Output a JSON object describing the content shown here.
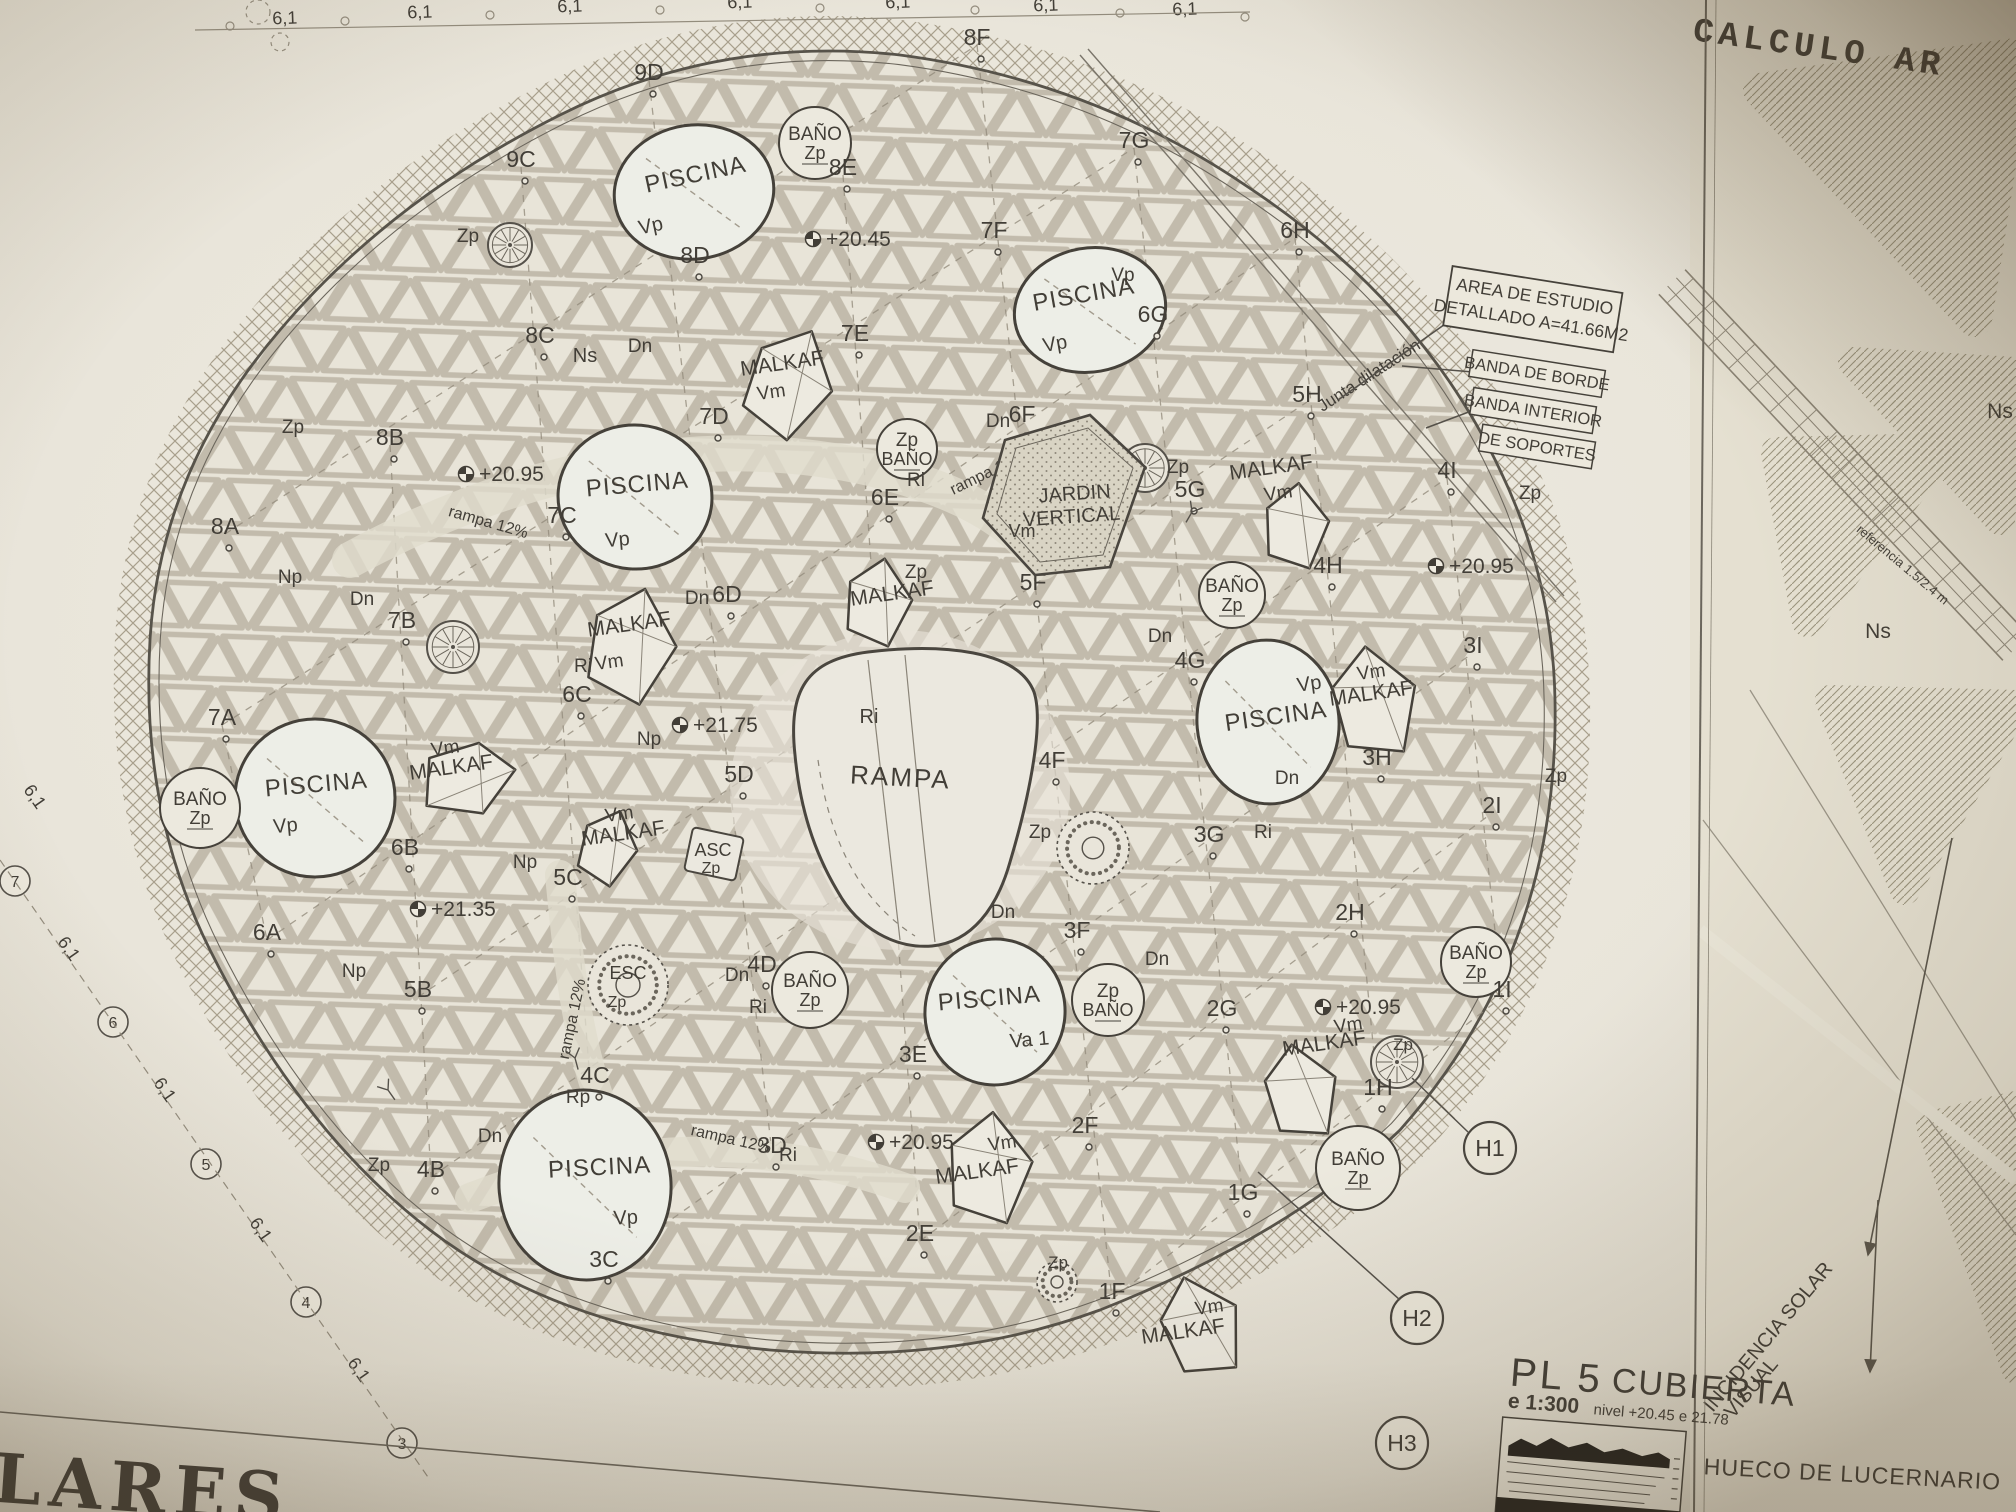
{
  "colors": {
    "paper": "#e9e5da",
    "ink": "#423e37",
    "ink_light": "#7b766a",
    "lattice": "#c0b9aa",
    "pool_fill": "#edeee7",
    "hatch": "#a89f8c"
  },
  "titles": {
    "corner": "CALCULO AR",
    "bottom_left": "LARES"
  },
  "title_block": {
    "code": "PL 5",
    "name": "CUBIERTA",
    "scale": "e 1:300",
    "levels": "nivel +20.45 e 21.78"
  },
  "callouts": {
    "area1": "AREA DE ESTUDIO",
    "area2": "DETALLADO A=41.66M2",
    "banda1": "BANDA DE BORDE",
    "banda2": "BANDA INTERIOR",
    "banda3": "DE SOPORTES"
  },
  "panel": {
    "hueco": "HUECO DE LUCERNARIO",
    "inc1": "INCIDENCIA SOLAR",
    "inc2": "VISUAL"
  },
  "labels": {
    "piscina": "PISCINA",
    "malkaf": "MALKAF",
    "vm": "Vm",
    "rampa": "RAMPA",
    "rampa_ri": "Ri",
    "jardin1": "JARDIN",
    "jardin2": "VERTICAL",
    "jardin_tag": "Vm",
    "asc1": "ASC",
    "asc2": "Zp",
    "esc1": "ESC",
    "esc2": "Zp"
  },
  "grid_points": [
    [
      "9C",
      521,
      167
    ],
    [
      "9D",
      649,
      80
    ],
    [
      "8A",
      225,
      534
    ],
    [
      "8B",
      390,
      445
    ],
    [
      "8C",
      540,
      343
    ],
    [
      "8D",
      695,
      263
    ],
    [
      "8E",
      843,
      175
    ],
    [
      "8F",
      977,
      45
    ],
    [
      "7A",
      222,
      725
    ],
    [
      "7B",
      402,
      628
    ],
    [
      "7C",
      562,
      523
    ],
    [
      "7D",
      714,
      424
    ],
    [
      "7E",
      855,
      341
    ],
    [
      "7F",
      994,
      238
    ],
    [
      "7G",
      1134,
      148
    ],
    [
      "6A",
      267,
      940
    ],
    [
      "6B",
      405,
      855
    ],
    [
      "6C",
      577,
      702
    ],
    [
      "6D",
      727,
      602
    ],
    [
      "6E",
      885,
      505
    ],
    [
      "6F",
      1022,
      422
    ],
    [
      "6G",
      1153,
      322
    ],
    [
      "6H",
      1295,
      238
    ],
    [
      "5B",
      418,
      997
    ],
    [
      "5C",
      568,
      885
    ],
    [
      "5D",
      739,
      782
    ],
    [
      "5F",
      1033,
      590
    ],
    [
      "5G",
      1190,
      497
    ],
    [
      "5H",
      1307,
      402
    ],
    [
      "4B",
      431,
      1177
    ],
    [
      "4C",
      595,
      1083
    ],
    [
      "4D",
      762,
      972
    ],
    [
      "4F",
      1052,
      768
    ],
    [
      "4G",
      1190,
      668
    ],
    [
      "4H",
      1328,
      573
    ],
    [
      "4I",
      1447,
      478
    ],
    [
      "3C",
      604,
      1267
    ],
    [
      "3D",
      772,
      1153
    ],
    [
      "3E",
      913,
      1062
    ],
    [
      "3F",
      1077,
      938
    ],
    [
      "3G",
      1209,
      842
    ],
    [
      "3H",
      1377,
      765
    ],
    [
      "3I",
      1473,
      653
    ],
    [
      "2E",
      920,
      1241
    ],
    [
      "2F",
      1085,
      1133
    ],
    [
      "2G",
      1222,
      1016
    ],
    [
      "2H",
      1350,
      920
    ],
    [
      "2I",
      1492,
      813
    ],
    [
      "1F",
      1112,
      1299
    ],
    [
      "1G",
      1243,
      1200
    ],
    [
      "1H",
      1378,
      1095
    ],
    [
      "1I",
      1502,
      997
    ]
  ],
  "levels": [
    [
      "+20.45",
      827,
      245
    ],
    [
      "+20.95",
      480,
      480
    ],
    [
      "+21.75",
      694,
      731
    ],
    [
      "+21.35",
      432,
      915
    ],
    [
      "+20.95",
      1450,
      572
    ],
    [
      "+20.95",
      890,
      1148
    ],
    [
      "+20.95",
      1337,
      1013
    ]
  ],
  "pools": [
    {
      "x": 694,
      "y": 192,
      "rx": 80,
      "ry": 67,
      "rot": -8,
      "lx": 697,
      "ly": 182,
      "lr": -12,
      "tag": "Vp",
      "tx": 652,
      "ty": 232
    },
    {
      "x": 1090,
      "y": 310,
      "rx": 76,
      "ry": 62,
      "rot": -10,
      "lx": 1085,
      "ly": 302,
      "lr": -10,
      "tag": "Vp",
      "tx": 1056,
      "ty": 350
    },
    {
      "x": 635,
      "y": 497,
      "rx": 77,
      "ry": 72,
      "rot": 5,
      "lx": 638,
      "ly": 492,
      "lr": -5,
      "tag": "Vp",
      "tx": 618,
      "ty": 546
    },
    {
      "x": 315,
      "y": 798,
      "rx": 80,
      "ry": 79,
      "rot": 0,
      "lx": 317,
      "ly": 792,
      "lr": -5,
      "tag": "Vp",
      "tx": 286,
      "ty": 832
    },
    {
      "x": 1268,
      "y": 722,
      "rx": 71,
      "ry": 82,
      "rot": -5,
      "lx": 1277,
      "ly": 724,
      "lr": -8,
      "tag": "Vp",
      "tx": 1310,
      "ty": 690
    },
    {
      "x": 995,
      "y": 1012,
      "rx": 70,
      "ry": 73,
      "rot": 8,
      "lx": 990,
      "ly": 1006,
      "lr": -5,
      "tag": "Va 1",
      "tx": 1030,
      "ty": 1046
    },
    {
      "x": 585,
      "y": 1185,
      "rx": 86,
      "ry": 95,
      "rot": -5,
      "lx": 600,
      "ly": 1175,
      "lr": -3,
      "tag": "Vp",
      "tx": 626,
      "ty": 1224
    }
  ],
  "malkafs": [
    {
      "x": 788,
      "y": 382,
      "s": 56,
      "rot": 25,
      "lx": 783,
      "ly": 370,
      "vx": 772,
      "vy": 398
    },
    {
      "x": 630,
      "y": 645,
      "s": 58,
      "rot": 15,
      "lx": 630,
      "ly": 631,
      "vx": 610,
      "vy": 668
    },
    {
      "x": 468,
      "y": 778,
      "s": 48,
      "rot": 80,
      "lx": 452,
      "ly": 774,
      "vx": 446,
      "vy": 754
    },
    {
      "x": 607,
      "y": 847,
      "s": 38,
      "rot": 20,
      "lx": 624,
      "ly": 840,
      "vx": 620,
      "vy": 820
    },
    {
      "x": 877,
      "y": 602,
      "s": 44,
      "rot": 10,
      "lx": 893,
      "ly": 600,
      "vx": null,
      "vy": null
    },
    {
      "x": 1373,
      "y": 702,
      "s": 56,
      "rot": -8,
      "lx": 1372,
      "ly": 700,
      "vx": 1372,
      "vy": 678
    },
    {
      "x": 1295,
      "y": 526,
      "s": 43,
      "rot": 5,
      "lx": 1272,
      "ly": 474,
      "vx": 1279,
      "vy": 499
    },
    {
      "x": 1300,
      "y": 1092,
      "s": 48,
      "rot": -10,
      "lx": 1325,
      "ly": 1050,
      "vx": 1349,
      "vy": 1031
    },
    {
      "x": 988,
      "y": 1168,
      "s": 56,
      "rot": 5,
      "lx": 978,
      "ly": 1178,
      "vx": 1003,
      "vy": 1149
    },
    {
      "x": 1200,
      "y": 1327,
      "s": 52,
      "rot": -18,
      "lx": 1184,
      "ly": 1338,
      "vx": 1210,
      "vy": 1313
    }
  ],
  "banos": [
    {
      "x": 815,
      "y": 143,
      "r": 36,
      "l1": "BAÑO",
      "l2": "Zp"
    },
    {
      "x": 200,
      "y": 808,
      "r": 40,
      "l1": "BAÑO",
      "l2": "Zp"
    },
    {
      "x": 907,
      "y": 449,
      "r": 30,
      "l1": "Zp",
      "l2": "BAÑO"
    },
    {
      "x": 1232,
      "y": 595,
      "r": 33,
      "l1": "BAÑO",
      "l2": "Zp"
    },
    {
      "x": 810,
      "y": 990,
      "r": 38,
      "l1": "BAÑO",
      "l2": "Zp"
    },
    {
      "x": 1108,
      "y": 1000,
      "r": 36,
      "l1": "Zp",
      "l2": "BAÑO"
    },
    {
      "x": 1476,
      "y": 962,
      "r": 35,
      "l1": "BAÑO",
      "l2": "Zp"
    },
    {
      "x": 1358,
      "y": 1168,
      "r": 42,
      "l1": "BAÑO",
      "l2": "Zp"
    }
  ],
  "rosettes": [
    {
      "x": 510,
      "y": 245,
      "r": 22,
      "style": "wheel"
    },
    {
      "x": 453,
      "y": 647,
      "r": 26,
      "style": "wheel"
    },
    {
      "x": 1145,
      "y": 468,
      "r": 24,
      "style": "wheel"
    },
    {
      "x": 1397,
      "y": 1062,
      "r": 26,
      "style": "wheel"
    },
    {
      "x": 1093,
      "y": 848,
      "r": 36,
      "style": "dotted"
    },
    {
      "x": 1057,
      "y": 1282,
      "r": 20,
      "style": "dotted"
    },
    {
      "x": 628,
      "y": 985,
      "r": 40,
      "style": "dotted"
    }
  ],
  "notes": [
    [
      "Zp",
      293,
      433,
      0,
      19
    ],
    [
      "Zp",
      468,
      242,
      0,
      19
    ],
    [
      "Zp",
      825,
      793,
      0,
      19
    ],
    [
      "Zp",
      968,
      849,
      0,
      19
    ],
    [
      "Zp",
      1040,
      838,
      0,
      19
    ],
    [
      "Zp",
      1178,
      473,
      0,
      19
    ],
    [
      "Zp",
      1530,
      499,
      0,
      19
    ],
    [
      "Zp",
      1556,
      782,
      0,
      19
    ],
    [
      "Zp",
      379,
      1171,
      0,
      19
    ],
    [
      "Zp",
      1403,
      1050,
      0,
      17
    ],
    [
      "Zp",
      1058,
      1268,
      0,
      17
    ],
    [
      "Zp",
      916,
      578,
      0,
      19
    ],
    [
      "Dn",
      998,
      427,
      0,
      19
    ],
    [
      "Dn",
      697,
      604,
      0,
      19
    ],
    [
      "Dn",
      362,
      605,
      0,
      19
    ],
    [
      "Dn",
      640,
      352,
      0,
      19
    ],
    [
      "Dn",
      1287,
      784,
      0,
      19
    ],
    [
      "Dn",
      1157,
      965,
      0,
      19
    ],
    [
      "Dn",
      1003,
      918,
      0,
      19
    ],
    [
      "Dn",
      737,
      981,
      0,
      19
    ],
    [
      "Dn",
      490,
      1142,
      0,
      19
    ],
    [
      "Dn",
      1160,
      642,
      0,
      19
    ],
    [
      "Np",
      290,
      583,
      0,
      19
    ],
    [
      "Np",
      649,
      745,
      0,
      19
    ],
    [
      "Np",
      525,
      868,
      0,
      19
    ],
    [
      "Np",
      354,
      977,
      0,
      19
    ],
    [
      "Ri",
      916,
      486,
      0,
      19
    ],
    [
      "Ri",
      583,
      672,
      0,
      19
    ],
    [
      "Ri",
      758,
      1013,
      0,
      19
    ],
    [
      "Ri",
      788,
      1161,
      0,
      19
    ],
    [
      "Ri",
      1263,
      838,
      0,
      19
    ],
    [
      "Rp",
      578,
      1103,
      0,
      19
    ],
    [
      "Ns",
      585,
      362,
      0,
      20
    ],
    [
      "Ns",
      2000,
      418,
      0,
      21
    ],
    [
      "Ns",
      1878,
      638,
      0,
      21
    ],
    [
      "Vp",
      1123,
      281,
      0,
      19
    ],
    [
      "rampa 12%",
      990,
      477,
      -26,
      16
    ],
    [
      "rampa 12%",
      487,
      527,
      16,
      16
    ],
    [
      "rampa 12%",
      577,
      1020,
      -78,
      16
    ],
    [
      "rampa 12%",
      730,
      1144,
      13,
      16
    ],
    [
      "Junta dilatación",
      1372,
      380,
      -33,
      17
    ],
    [
      "referencia 1.5/2.4 m",
      1900,
      568,
      40,
      13
    ]
  ],
  "dims_top": [
    [
      "6,1",
      285,
      24
    ],
    [
      "6,1",
      420,
      18
    ],
    [
      "6,1",
      570,
      12
    ],
    [
      "6,1",
      740,
      8
    ],
    [
      "6,1",
      898,
      8
    ],
    [
      "6,1",
      1046,
      11
    ],
    [
      "6,1",
      1185,
      15
    ]
  ],
  "dims_left": [
    [
      "6,1",
      30,
      800
    ],
    [
      "6,1",
      64,
      952
    ],
    [
      "6,1",
      160,
      1093
    ],
    [
      "6,1",
      256,
      1233
    ],
    [
      "6,1",
      354,
      1373
    ]
  ],
  "axis_bubbles": [
    [
      "7",
      15,
      881
    ],
    [
      "6",
      113,
      1022
    ],
    [
      "5",
      206,
      1164
    ],
    [
      "4",
      306,
      1302
    ],
    [
      "3",
      402,
      1443
    ]
  ],
  "h_markers": [
    [
      "H1",
      1490,
      1148
    ],
    [
      "H2",
      1417,
      1318
    ],
    [
      "H3",
      1402,
      1443
    ]
  ]
}
